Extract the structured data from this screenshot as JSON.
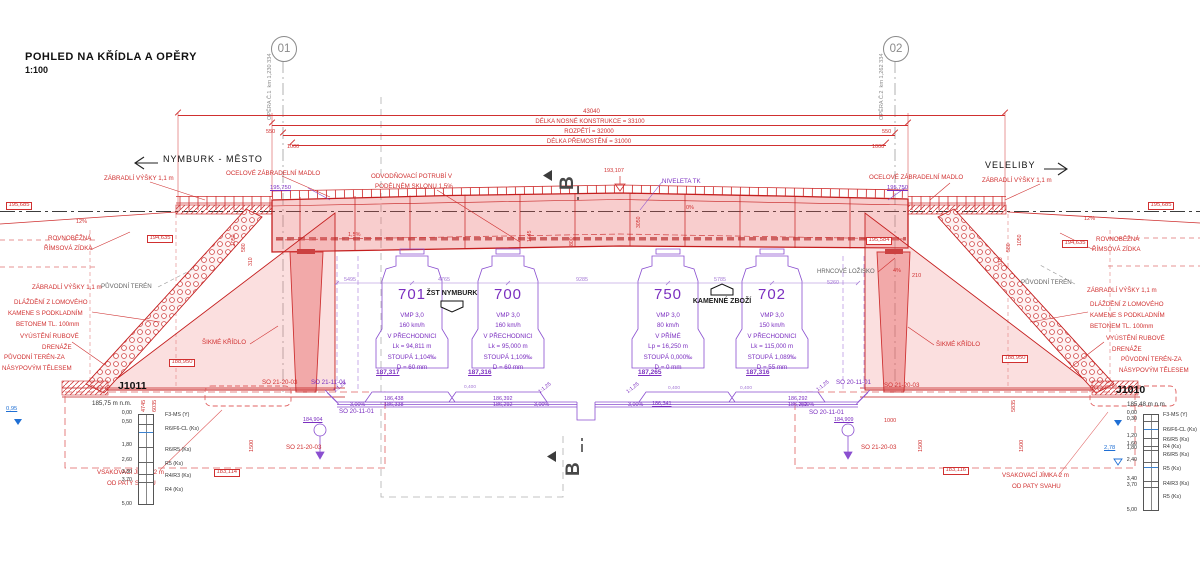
{
  "header": {
    "title": "POHLED NA KŘÍDLA A OPĚRY",
    "scale": "1:100"
  },
  "colors": {
    "red": "#d03030",
    "purple": "#7b2fc0",
    "lav": "#a57ad6",
    "blue": "#1f6fd4",
    "dark": "#1a1a1a",
    "gray": "#666666",
    "section": "#474747"
  },
  "directions": {
    "left": "NYMBURK - MĚSTO",
    "right": "VELELIBY"
  },
  "axes": [
    {
      "id": "01",
      "x": 283,
      "label1": "OPĚRA Č.1",
      "label2": "km 1,230 334"
    },
    {
      "id": "02",
      "x": 895,
      "label1": "OPĚRA Č.2",
      "label2": "km 1,262 334"
    }
  ],
  "top_dimensions": [
    {
      "label": "43040",
      "y": 115,
      "x1": 178,
      "x2": 1005
    },
    {
      "label": "DÉLKA NOSNÉ KONSTRUKCE = 33100",
      "y": 125,
      "x1": 272,
      "x2": 908
    },
    {
      "label": "ROZPĚTÍ = 32000",
      "y": 135,
      "x1": 283,
      "x2": 895
    },
    {
      "label": "DÉLKA PŘEMOSTĚNÍ = 31000",
      "y": 145,
      "x1": 292,
      "x2": 886
    }
  ],
  "tracks": [
    {
      "number": "701",
      "x": 412,
      "level": "187,317",
      "level_x": 376,
      "lines": [
        "VMP 3,0",
        "160 km/h",
        "V PŘECHODNICI",
        "Lk = 94,811 m",
        "STOUPÁ 1,104‰",
        "D = 60 mm"
      ]
    },
    {
      "number": "700",
      "x": 508,
      "level": "187,316",
      "level_x": 468,
      "lines": [
        "VMP 3,0",
        "160 km/h",
        "V PŘECHODNICI",
        "Lk = 95,000 m",
        "STOUPÁ 1,109‰",
        "D = 60 mm"
      ]
    },
    {
      "number": "750",
      "x": 668,
      "level": "187,265",
      "level_x": 638,
      "lines": [
        "VMP 3,0",
        "80 km/h",
        "V PŘÍMÉ",
        "Lp = 16,250 m",
        "STOUPÁ 0,000‰",
        "D = 0 mm"
      ]
    },
    {
      "number": "702",
      "x": 772,
      "level": "187,316",
      "level_x": 746,
      "lines": [
        "VMP 3,0",
        "150 km/h",
        "V PŘECHODNICI",
        "Lk = 115,000 m",
        "STOUPÁ 1,089‰",
        "D = 55 mm"
      ]
    }
  ],
  "boreholes": [
    {
      "id": "J1011",
      "elevation": "185,75 m n.m.",
      "title": {
        "x": 118,
        "y": 381
      },
      "elev_pos": {
        "x": 92,
        "y": 401
      },
      "col": {
        "x": 138,
        "top": 414,
        "bottom": 505,
        "w": 16
      },
      "boundaries": [
        423,
        446,
        461,
        473,
        481
      ],
      "water_lines": [
        431
      ],
      "tick_x": 132,
      "layer_x": 165,
      "ticks": [
        {
          "v": "0,00",
          "y": 414
        },
        {
          "v": "0,50",
          "y": 423
        },
        {
          "v": "1,80",
          "y": 446
        },
        {
          "v": "2,60",
          "y": 461
        },
        {
          "v": "3,30",
          "y": 473
        },
        {
          "v": "3,70",
          "y": 481
        },
        {
          "v": "5,00",
          "y": 505
        }
      ],
      "layers": [
        {
          "t": "F3-MS (Y)",
          "y": 416
        },
        {
          "t": "R6/F6-CL (Ks)",
          "y": 430
        },
        {
          "t": "R6/R5 (Ks)",
          "y": 451
        },
        {
          "t": "R5 (Ks)",
          "y": 465
        },
        {
          "t": "R4/R3 (Ks)",
          "y": 477
        },
        {
          "t": "R4 (Ks)",
          "y": 491
        }
      ]
    },
    {
      "id": "J1010",
      "elevation": "185,48 m n.m.",
      "title": {
        "x": 1116,
        "y": 385
      },
      "elev_pos": {
        "x": 1127,
        "y": 402
      },
      "col": {
        "x": 1143,
        "top": 414,
        "bottom": 511,
        "w": 16
      },
      "boundaries": [
        420,
        437,
        445,
        449,
        461,
        480,
        486
      ],
      "water_lines": [
        428,
        466
      ],
      "tick_x": 1137,
      "layer_x": 1163,
      "ticks": [
        {
          "v": "0,00",
          "y": 414
        },
        {
          "v": "0,30",
          "y": 420
        },
        {
          "v": "1,20",
          "y": 437
        },
        {
          "v": "1,60",
          "y": 445
        },
        {
          "v": "1,80",
          "y": 449
        },
        {
          "v": "2,40",
          "y": 461
        },
        {
          "v": "3,40",
          "y": 480
        },
        {
          "v": "3,70",
          "y": 486
        },
        {
          "v": "5,00",
          "y": 511
        }
      ],
      "layers": [
        {
          "t": "F3-MS (Y)",
          "y": 416
        },
        {
          "t": "R6/F6-CL (Ks)",
          "y": 431
        },
        {
          "t": "R6/R5 (Ks)",
          "y": 441
        },
        {
          "t": "R4 (Ks)",
          "y": 448
        },
        {
          "t": "R6/R5 (Ks)",
          "y": 456
        },
        {
          "t": "R5 (Ks)",
          "y": 470
        },
        {
          "t": "R4/R3 (Ks)",
          "y": 485
        },
        {
          "t": "R5 (Ks)",
          "y": 498
        }
      ]
    }
  ],
  "annotations": [
    {
      "n": "railing-label-left",
      "t": "ZÁBRADLÍ VÝŠKY 1,1 m",
      "x": 104,
      "y": 176
    },
    {
      "n": "handrail-label-left",
      "t": "OCELOVÉ ZÁBRADELNÍ MADLO",
      "x": 226,
      "y": 171
    },
    {
      "n": "drainpipe-label-1",
      "t": "ODVODŇOVACÍ POTRUBÍ V",
      "x": 371,
      "y": 174
    },
    {
      "n": "drainpipe-label-2",
      "t": "PODÉLNÉM SKLONU 1,5%",
      "x": 375,
      "y": 184
    },
    {
      "n": "handrail-label-right",
      "t": "OCELOVÉ ZÁBRADELNÍ MADLO",
      "x": 869,
      "y": 175
    },
    {
      "n": "railing-label-right",
      "t": "ZÁBRADLÍ VÝŠKY 1,1 m",
      "x": 982,
      "y": 178
    },
    {
      "n": "cornice-wall-left-1",
      "t": "ROVNOBĚŽNÁ",
      "x": 48,
      "y": 236
    },
    {
      "n": "cornice-wall-left-2",
      "t": "ŘÍMSOVÁ ZÍDKA",
      "x": 44,
      "y": 246
    },
    {
      "n": "cornice-wall-right-1",
      "t": "ROVNOBĚŽNÁ",
      "x": 1096,
      "y": 237
    },
    {
      "n": "cornice-wall-right-2",
      "t": "ŘÍMSOVÁ ZÍDKA",
      "x": 1092,
      "y": 247
    },
    {
      "n": "slope-12-left",
      "t": "12%",
      "x": 76,
      "y": 220,
      "s": 5.5
    },
    {
      "n": "slope-12-right",
      "t": "12%",
      "x": 1084,
      "y": 217,
      "s": 5.5
    },
    {
      "n": "railing-label-left-2",
      "t": "ZÁBRADLÍ VÝŠKY 1,1 m",
      "x": 32,
      "y": 285
    },
    {
      "n": "railing-label-right-2",
      "t": "ZÁBRADLÍ VÝŠKY 1,1 m",
      "x": 1087,
      "y": 288
    },
    {
      "n": "paving-left-1",
      "t": "DLÁŽDĚNÍ Z LOMOVÉHO",
      "x": 14,
      "y": 300
    },
    {
      "n": "paving-left-2",
      "t": "KAMENE S PODKLADNÍM",
      "x": 8,
      "y": 311
    },
    {
      "n": "paving-left-3",
      "t": "BETONEM TL. 100mm",
      "x": 16,
      "y": 322
    },
    {
      "n": "paving-right-1",
      "t": "DLÁŽDĚNÍ Z LOMOVÉHO",
      "x": 1090,
      "y": 302
    },
    {
      "n": "paving-right-2",
      "t": "KAMENE S PODKLADNÍM",
      "x": 1090,
      "y": 313
    },
    {
      "n": "paving-right-3",
      "t": "BETONEM TL. 100mm",
      "x": 1090,
      "y": 324
    },
    {
      "n": "drain-outlet-left-1",
      "t": "VYÚSTĚNÍ RUBOVÉ",
      "x": 20,
      "y": 334
    },
    {
      "n": "drain-outlet-left-2",
      "t": "DRENÁŽE",
      "x": 42,
      "y": 345
    },
    {
      "n": "drain-outlet-right-1",
      "t": "VYÚSTĚNÍ RUBOVÉ",
      "x": 1106,
      "y": 336
    },
    {
      "n": "drain-outlet-right-2",
      "t": "DRENÁŽE",
      "x": 1112,
      "y": 347
    },
    {
      "n": "terrain-behind-left-1",
      "t": "PŮVODNÍ TERÉN-ZA",
      "x": 4,
      "y": 355
    },
    {
      "n": "terrain-behind-left-2",
      "t": "NÁSYPOVÝM TĚLESEM",
      "x": 2,
      "y": 366
    },
    {
      "n": "terrain-behind-right-1",
      "t": "PŮVODNÍ TERÉN-ZA",
      "x": 1121,
      "y": 357
    },
    {
      "n": "terrain-behind-right-2",
      "t": "NÁSYPOVÝM TĚLESEM",
      "x": 1119,
      "y": 368
    },
    {
      "n": "skew-wing-left",
      "t": "ŠIKMÉ KŘÍDLO",
      "x": 202,
      "y": 340
    },
    {
      "n": "skew-wing-right",
      "t": "ŠIKMÉ KŘÍDLO",
      "x": 936,
      "y": 342
    },
    {
      "n": "soak-pit-left-1",
      "t": "VSAKOVACÍ JÍMKA 2 m",
      "x": 97,
      "y": 470
    },
    {
      "n": "soak-pit-left-2",
      "t": "OD PATY SVAHU",
      "x": 107,
      "y": 481
    },
    {
      "n": "soak-pit-right-1",
      "t": "VSAKOVACÍ JÍMKA 2 m",
      "x": 1002,
      "y": 473
    },
    {
      "n": "soak-pit-right-2",
      "t": "OD PATY SVAHU",
      "x": 1012,
      "y": 484
    },
    {
      "n": "so-object",
      "t": "SO 21-20-03",
      "x": 262,
      "y": 380
    },
    {
      "n": "so-object",
      "t": "SO 21-20-03",
      "x": 286,
      "y": 445
    },
    {
      "n": "so-object",
      "t": "SO 21-20-03",
      "x": 884,
      "y": 383
    },
    {
      "n": "so-object",
      "t": "SO 21-20-03",
      "x": 861,
      "y": 445
    },
    {
      "n": "level-box",
      "t": "195,685",
      "x": 6,
      "y": 202,
      "box": 1,
      "s": 5.8
    },
    {
      "n": "level-box",
      "t": "195,685",
      "x": 1148,
      "y": 202,
      "box": 1,
      "s": 5.8
    },
    {
      "n": "level-box",
      "t": "194,635",
      "x": 147,
      "y": 235,
      "box": 1,
      "s": 5.8
    },
    {
      "n": "level-box",
      "t": "194,635",
      "x": 1062,
      "y": 240,
      "box": 1,
      "s": 5.8
    },
    {
      "n": "level-box",
      "t": "195,584",
      "x": 866,
      "y": 237,
      "box": 1,
      "s": 5.8
    },
    {
      "n": "level-box",
      "t": "188,950",
      "x": 169,
      "y": 359,
      "box": 1,
      "s": 5.8
    },
    {
      "n": "level-box",
      "t": "188,950",
      "x": 1002,
      "y": 355,
      "box": 1,
      "s": 5.8
    },
    {
      "n": "level-box",
      "t": "183,114",
      "x": 214,
      "y": 469,
      "box": 1,
      "s": 5.8
    },
    {
      "n": "level-box",
      "t": "183,116",
      "x": 943,
      "y": 467,
      "box": 1,
      "s": 5.8
    },
    {
      "n": "level-tk",
      "t": "193,107",
      "x": 604,
      "y": 169,
      "s": 5.5
    },
    {
      "n": "slope-0",
      "t": "0%",
      "x": 686,
      "y": 206,
      "s": 5.5
    },
    {
      "n": "slope-15",
      "t": "1,5%",
      "x": 348,
      "y": 233,
      "s": 5.5
    },
    {
      "n": "slope-4",
      "t": "4%",
      "x": 893,
      "y": 269,
      "s": 5.5
    },
    {
      "n": "dim",
      "t": "210",
      "x": 912,
      "y": 274,
      "s": 5.5
    },
    {
      "n": "dim",
      "t": "1000",
      "x": 287,
      "y": 145,
      "s": 5.5
    },
    {
      "n": "dim",
      "t": "1000",
      "x": 872,
      "y": 145,
      "s": 5.5
    },
    {
      "n": "dim",
      "t": "550",
      "x": 266,
      "y": 130,
      "s": 5.5
    },
    {
      "n": "dim",
      "t": "550",
      "x": 882,
      "y": 130,
      "s": 5.5
    },
    {
      "n": "dim",
      "t": "1000",
      "x": 884,
      "y": 419,
      "s": 5.5
    },
    {
      "n": "dim-v",
      "t": "4745",
      "x": 142,
      "y": 412,
      "r": -90,
      "s": 5.5
    },
    {
      "n": "dim-v",
      "t": "6035",
      "x": 153,
      "y": 412,
      "r": -90,
      "s": 5.5
    },
    {
      "n": "dim-v",
      "t": "1050",
      "x": 232,
      "y": 246,
      "r": -90,
      "s": 5.2
    },
    {
      "n": "dim-v",
      "t": "580",
      "x": 242,
      "y": 252,
      "r": -90,
      "s": 5.2
    },
    {
      "n": "dim-v",
      "t": "310",
      "x": 249,
      "y": 266,
      "r": -90,
      "s": 5.2
    },
    {
      "n": "dim-v",
      "t": "1050",
      "x": 1018,
      "y": 246,
      "r": -90,
      "s": 5.2
    },
    {
      "n": "dim-v",
      "t": "580",
      "x": 1007,
      "y": 252,
      "r": -90,
      "s": 5.2
    },
    {
      "n": "dim-v",
      "t": "310",
      "x": 999,
      "y": 266,
      "r": -90,
      "s": 5.2
    },
    {
      "n": "dim-v",
      "t": "5835",
      "x": 1012,
      "y": 412,
      "r": -90,
      "s": 5.5
    },
    {
      "n": "dim-v",
      "t": "1500",
      "x": 250,
      "y": 452,
      "r": -90,
      "s": 5.5
    },
    {
      "n": "dim-v",
      "t": "1500",
      "x": 919,
      "y": 452,
      "r": -90,
      "s": 5.5
    },
    {
      "n": "dim-v",
      "t": "1500",
      "x": 1020,
      "y": 452,
      "r": -90,
      "s": 5.5
    },
    {
      "n": "dim-v",
      "t": "800",
      "x": 570,
      "y": 246,
      "r": -90,
      "s": 5.2
    },
    {
      "n": "dim-v",
      "t": "3050",
      "x": 637,
      "y": 228,
      "r": -90,
      "s": 5.2
    },
    {
      "n": "dim-v",
      "t": "1645",
      "x": 528,
      "y": 242,
      "r": -90,
      "s": 5.2
    },
    {
      "n": "rail-level",
      "t": "195,750",
      "x": 270,
      "y": 186,
      "c": "purple",
      "u": 1,
      "s": 5.8
    },
    {
      "n": "rail-level",
      "t": "195,750",
      "x": 887,
      "y": 186,
      "c": "purple",
      "u": 1,
      "s": 5.8
    },
    {
      "n": "niveleta-tk",
      "t": "NIVELETA TK",
      "x": 662,
      "y": 179,
      "c": "purple"
    },
    {
      "n": "formation-level",
      "t": "186,438",
      "x": 384,
      "y": 397,
      "c": "purple",
      "s": 5.4
    },
    {
      "n": "formation-level",
      "t": "186,338",
      "x": 384,
      "y": 403,
      "c": "purple",
      "s": 5.4
    },
    {
      "n": "formation-level",
      "t": "186,392",
      "x": 493,
      "y": 397,
      "c": "purple",
      "s": 5.4
    },
    {
      "n": "formation-level",
      "t": "186,292",
      "x": 493,
      "y": 403,
      "c": "purple",
      "s": 5.4
    },
    {
      "n": "formation-level",
      "t": "186,341",
      "x": 652,
      "y": 402,
      "c": "purple",
      "u": 1,
      "s": 5.4
    },
    {
      "n": "formation-level",
      "t": "186,292",
      "x": 788,
      "y": 397,
      "c": "purple",
      "s": 5.4
    },
    {
      "n": "formation-level",
      "t": "186,262",
      "x": 788,
      "y": 403,
      "c": "purple",
      "s": 5.4
    },
    {
      "n": "slope-3pct",
      "t": "3,00%",
      "x": 350,
      "y": 403,
      "c": "purple",
      "s": 5.4
    },
    {
      "n": "slope-3pct",
      "t": "3,00%",
      "x": 534,
      "y": 403,
      "c": "purple",
      "s": 5.4
    },
    {
      "n": "slope-3pct",
      "t": "3,00%",
      "x": 628,
      "y": 403,
      "c": "purple",
      "s": 5.4
    },
    {
      "n": "slope-3pct",
      "t": "3,00%",
      "x": 799,
      "y": 403,
      "c": "purple",
      "s": 5.4
    },
    {
      "n": "slope-ratio",
      "t": "1:1,25",
      "x": 333,
      "y": 390,
      "c": "purple",
      "r": -38,
      "s": 5.2
    },
    {
      "n": "slope-ratio",
      "t": "1:1,25",
      "x": 538,
      "y": 391,
      "c": "purple",
      "r": -38,
      "s": 5.2
    },
    {
      "n": "slope-ratio",
      "t": "1:1,25",
      "x": 626,
      "y": 391,
      "c": "purple",
      "r": -38,
      "s": 5.2
    },
    {
      "n": "slope-ratio",
      "t": "1:1,25",
      "x": 816,
      "y": 389,
      "c": "purple",
      "r": -38,
      "s": 5.2
    },
    {
      "n": "drain-level",
      "t": "184,904",
      "x": 303,
      "y": 418,
      "c": "purple",
      "s": 5.4,
      "u": 1
    },
    {
      "n": "drain-level",
      "t": "184,909",
      "x": 834,
      "y": 418,
      "c": "purple",
      "s": 5.4,
      "u": 1
    },
    {
      "n": "so-object",
      "t": "SO 21-11-01",
      "x": 311,
      "y": 380,
      "c": "purple"
    },
    {
      "n": "so-object",
      "t": "SO 20-11-01",
      "x": 339,
      "y": 409,
      "c": "purple"
    },
    {
      "n": "so-object",
      "t": "SO 20-11-01",
      "x": 836,
      "y": 380,
      "c": "purple"
    },
    {
      "n": "so-object",
      "t": "SO 20-11-01",
      "x": 809,
      "y": 410,
      "c": "purple"
    },
    {
      "n": "dim",
      "t": "5495",
      "x": 344,
      "y": 278,
      "c": "lav",
      "s": 5.4
    },
    {
      "n": "dim",
      "t": "4765",
      "x": 438,
      "y": 278,
      "c": "lav",
      "s": 5.4
    },
    {
      "n": "dim",
      "t": "9285",
      "x": 576,
      "y": 278,
      "c": "lav",
      "s": 5.4
    },
    {
      "n": "dim",
      "t": "5785",
      "x": 714,
      "y": 278,
      "c": "lav",
      "s": 5.4
    },
    {
      "n": "dim",
      "t": "5260",
      "x": 827,
      "y": 281,
      "c": "lav",
      "s": 5.4
    },
    {
      "n": "dim",
      "t": "0,400",
      "x": 464,
      "y": 386,
      "c": "lav",
      "s": 4.8
    },
    {
      "n": "dim",
      "t": "0,400",
      "x": 668,
      "y": 387,
      "c": "lav",
      "s": 4.8
    },
    {
      "n": "dim",
      "t": "0,400",
      "x": 740,
      "y": 387,
      "c": "lav",
      "s": 4.8
    },
    {
      "n": "groundwater-depth",
      "t": "0,95",
      "x": 6,
      "y": 407,
      "c": "blue",
      "u": 1,
      "s": 5.8
    },
    {
      "n": "groundwater-depth",
      "t": "2,78",
      "x": 1104,
      "y": 446,
      "c": "blue",
      "u": 1,
      "s": 5.8
    },
    {
      "n": "station-label",
      "t": "ŽST NYMBURK",
      "x": 452,
      "y": 290,
      "c": "dark",
      "b": 1,
      "a": "c",
      "s": 7
    },
    {
      "n": "station-label",
      "t": "KAMENNÉ ZBOŽÍ",
      "x": 722,
      "y": 298,
      "c": "dark",
      "b": 1,
      "a": "c",
      "s": 7
    },
    {
      "n": "bearing-label",
      "t": "HRNCOVÉ LOŽISKO",
      "x": 817,
      "y": 269,
      "c": "gray",
      "s": 6
    },
    {
      "n": "original-terrain",
      "t": "PŮVODNÍ TERÉN",
      "x": 101,
      "y": 284,
      "c": "gray"
    },
    {
      "n": "original-terrain",
      "t": "PŮVODNÍ TERÉN",
      "x": 1021,
      "y": 280,
      "c": "gray"
    },
    {
      "n": "section-mark-b-top",
      "t": "B",
      "x": 558,
      "y": 190,
      "c": "section",
      "r": -90,
      "s": 19,
      "b": 1
    },
    {
      "n": "section-mark-b-bottom",
      "t": "B",
      "x": 564,
      "y": 476,
      "c": "section",
      "r": -90,
      "s": 19,
      "b": 1
    }
  ]
}
